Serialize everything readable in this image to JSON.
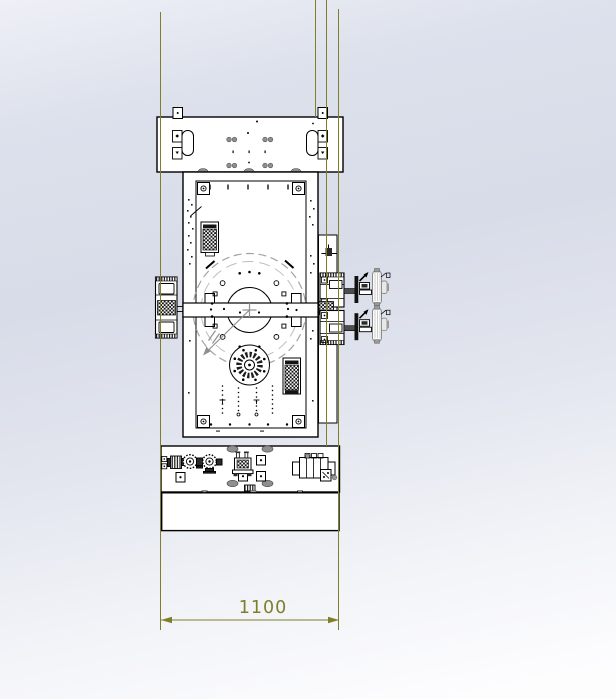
{
  "viewport": {
    "type": "cad-drawing-view",
    "dimension": {
      "value": "1100"
    },
    "colors": {
      "construction_line": "#7f7f2b",
      "drawing_line": "#000000",
      "centerline_gray": "#8f8f8f",
      "shaded_part_gray": "#8f8f8f",
      "background_top": "#dde1ec",
      "background_bottom": "#fdfdfe"
    }
  }
}
